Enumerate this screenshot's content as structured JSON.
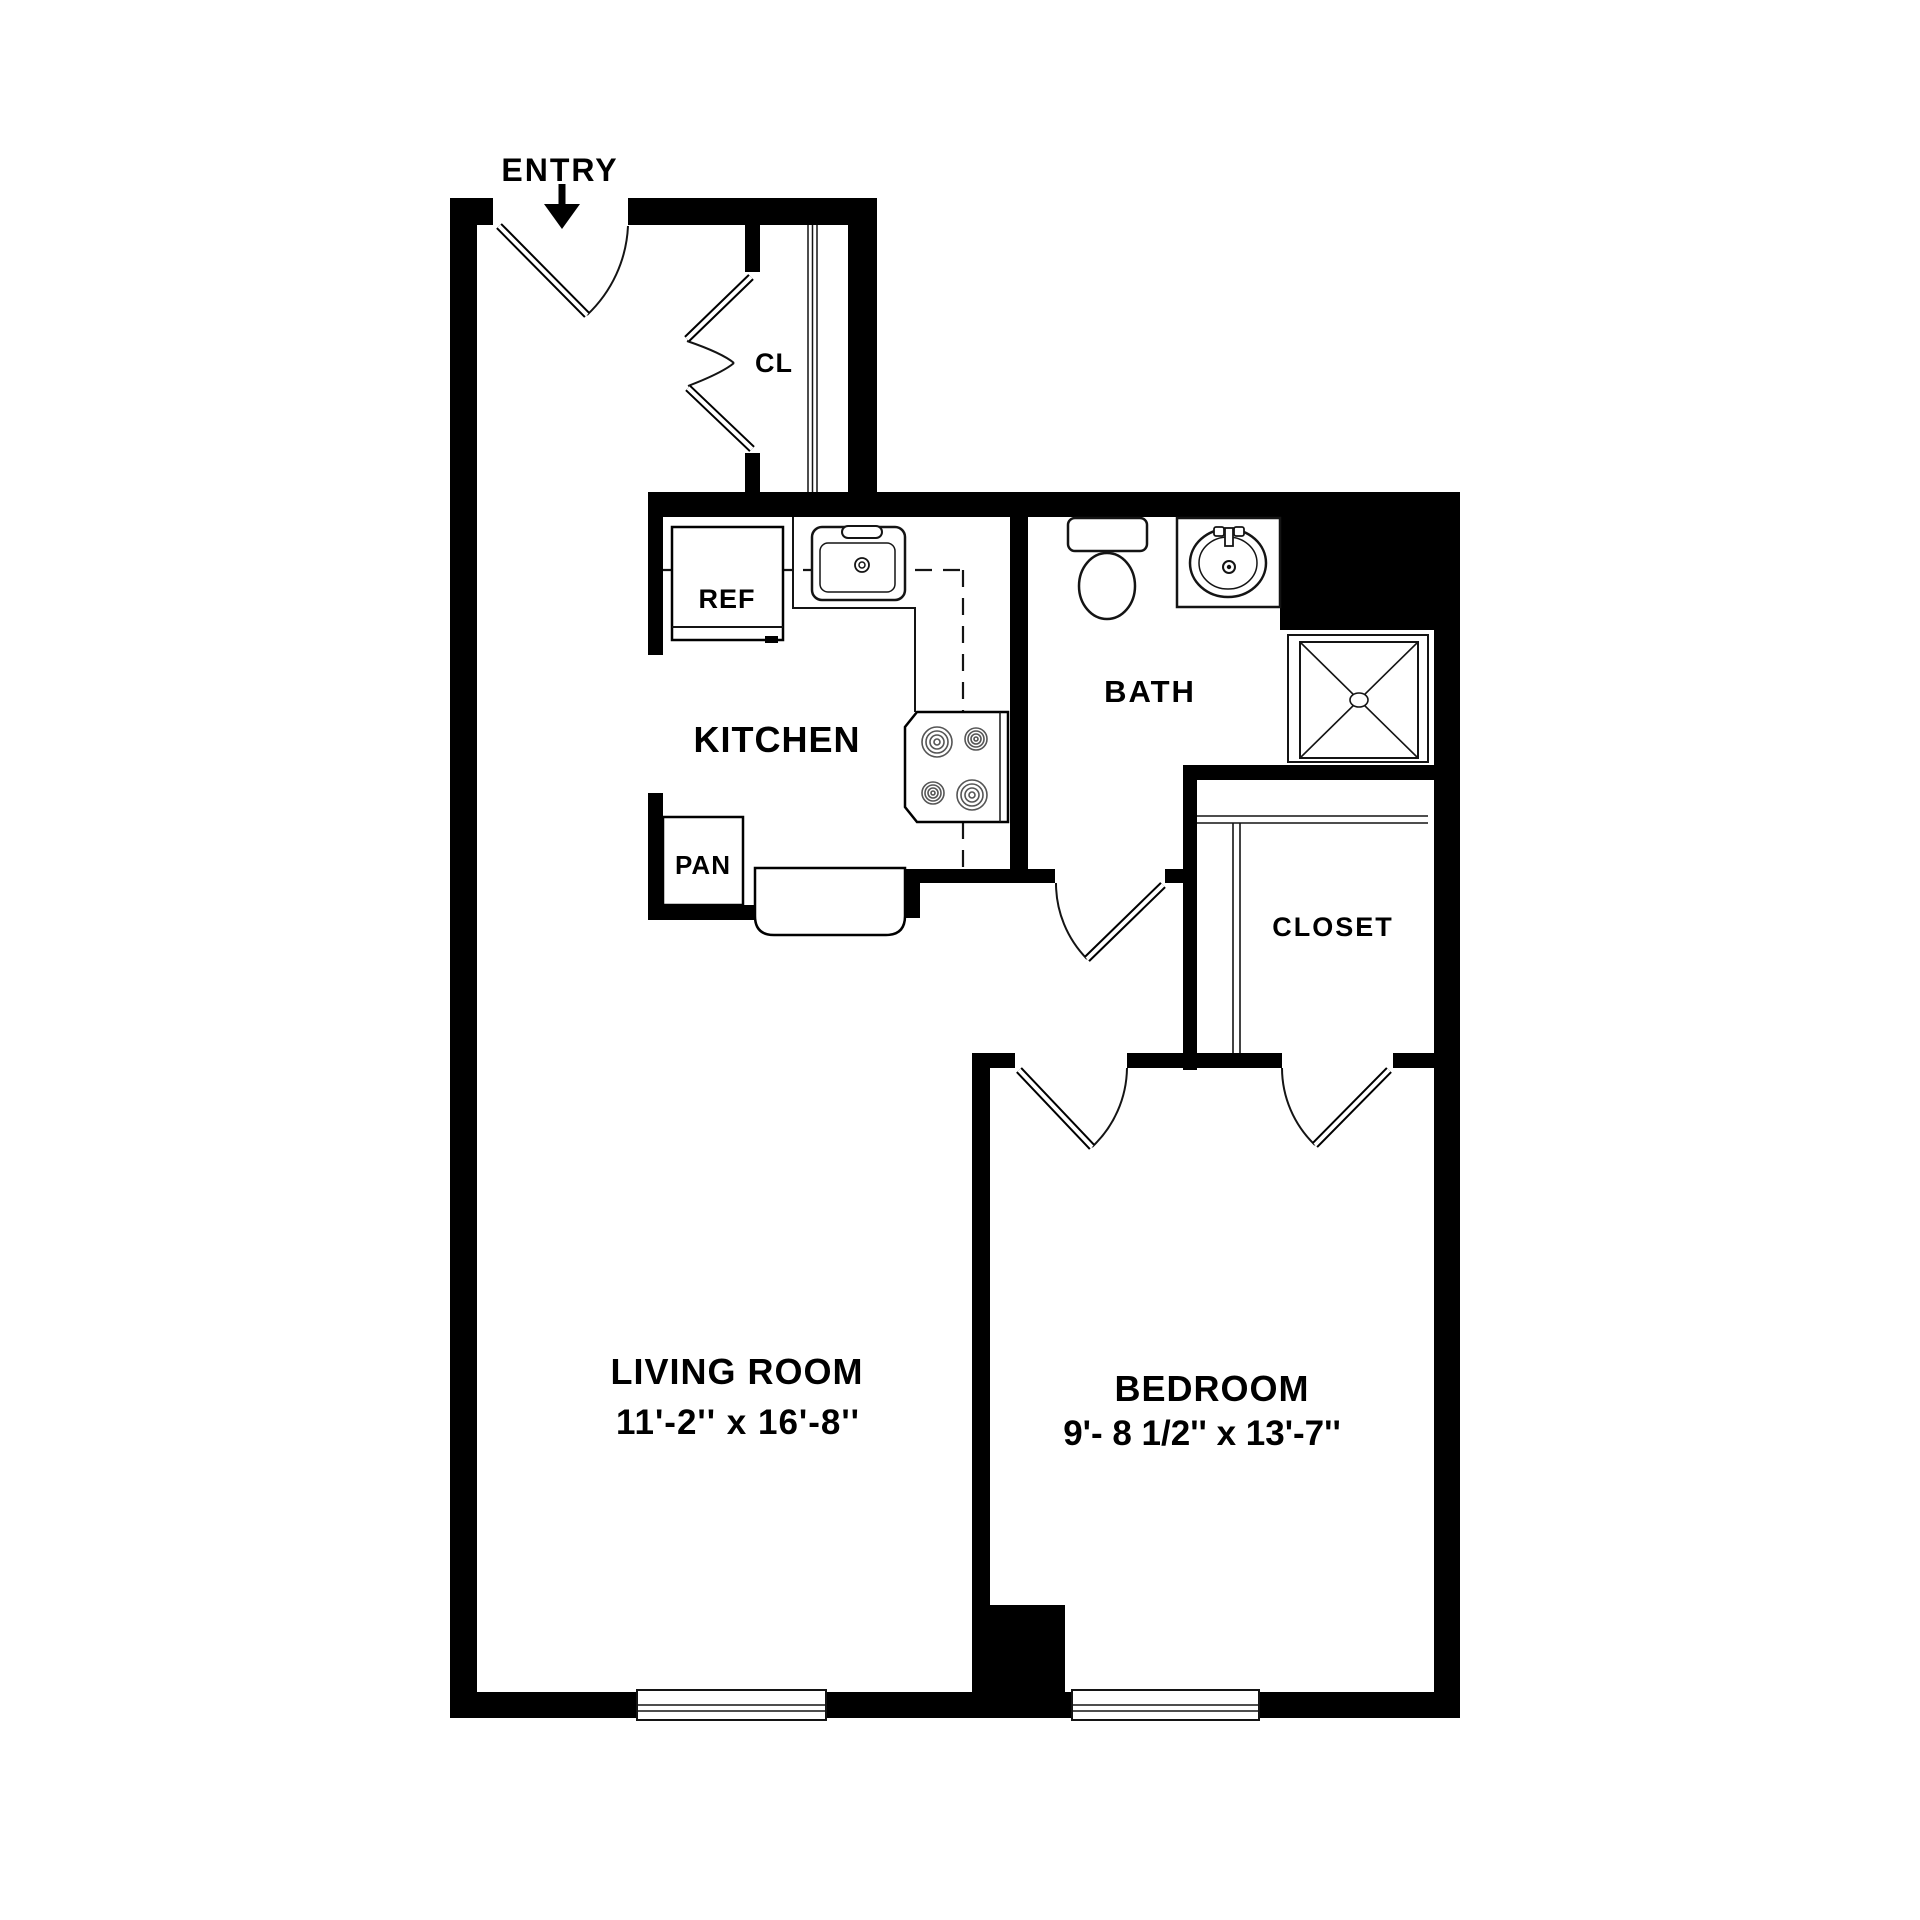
{
  "colors": {
    "wall": "#000000",
    "background": "#ffffff",
    "line": "#141414"
  },
  "labels": {
    "entry": "ENTRY",
    "entry_closet": "CL",
    "kitchen": "KITCHEN",
    "refrigerator": "REF",
    "pantry": "PAN",
    "bath": "BATH",
    "closet": "CLOSET",
    "living_room": "LIVING ROOM",
    "living_room_dimensions": "11'-2'' x 16'-8''",
    "bedroom": "BEDROOM",
    "bedroom_dimensions": "9'- 8 1/2'' x 13'-7''"
  }
}
